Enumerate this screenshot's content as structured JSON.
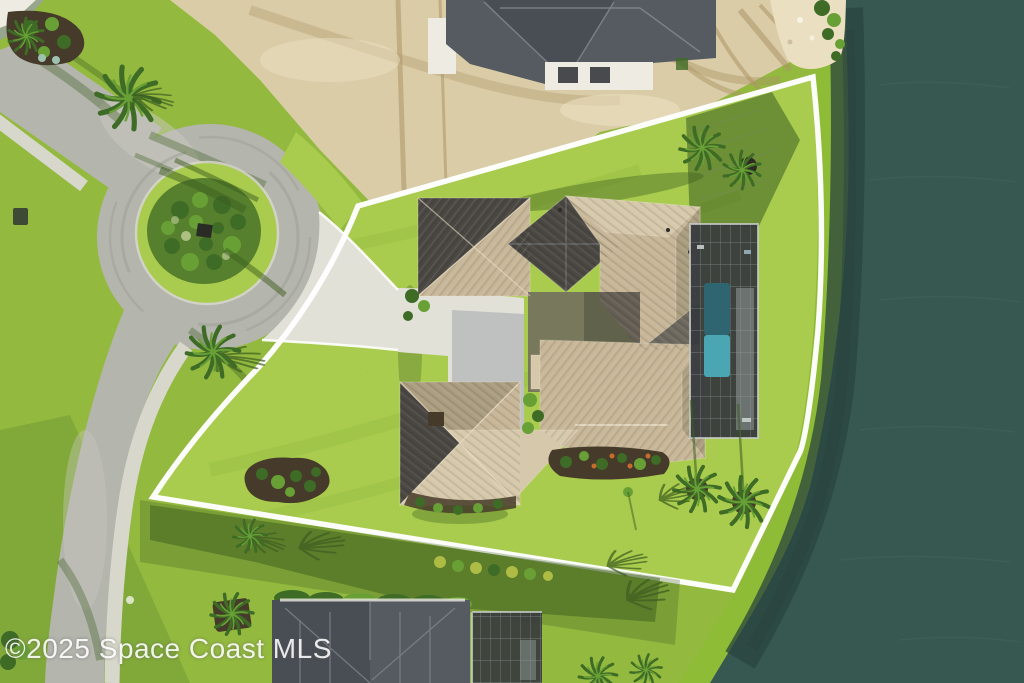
{
  "meta": {
    "kind": "aerial real-estate drone photograph",
    "width": 1024,
    "height": 683,
    "description": "Overhead view of a waterfront single-family home with a screened pool enclosure on a cul-de-sac lot outlined in white; lake to the right, sandy construction lot and house under construction at top, neighboring homes at bottom and top-left."
  },
  "watermark": {
    "text": "©2025 Space Coast MLS"
  },
  "colors": {
    "grass-base": "#93b93f",
    "grass-bright": "#a9cc4e",
    "grass-dark": "#6f9a33",
    "grass-shadow": "#3d5d20",
    "bank-grass": "#8fbc37",
    "water": "#375751",
    "water-dark": "#2a443f",
    "water-light": "#476a61",
    "sand": "#d9cca7",
    "sand-light": "#ebdfc1",
    "sand-track": "#ae9566",
    "road": "#b4b5ad",
    "road-light": "#c9c9c1",
    "tire": "#9a9b92",
    "sidewalk": "#d7d7cb",
    "concrete": "#e2e1d8",
    "concrete-shadow": "#a0a8ab",
    "roof-tan": "#c7b697",
    "roof-tan-light": "#d6c8aa",
    "roof-tan-dark": "#ab9d7f",
    "roof-gray": "#4b4843",
    "roof-gray-mid": "#6e695f",
    "ridge": "#ece2cc",
    "roof-line": "#858b91",
    "wall-white": "#edebe2",
    "cage": "#36393d",
    "cage-line": "#82878b",
    "pool-deep": "#2e6571",
    "pool-bright": "#4aa6b2",
    "deck": "#9aa1a1",
    "shrub": "#3e6b26",
    "shrub-light": "#69a036",
    "mulch": "#463b2a",
    "flower": "#c76c2c",
    "hedge-yellow": "#aebc45",
    "neighbor-roof": "#494e54",
    "neighbor-roof-2": "#565b61",
    "boundary": "#ffffff",
    "watermark": "#ffffff"
  }
}
